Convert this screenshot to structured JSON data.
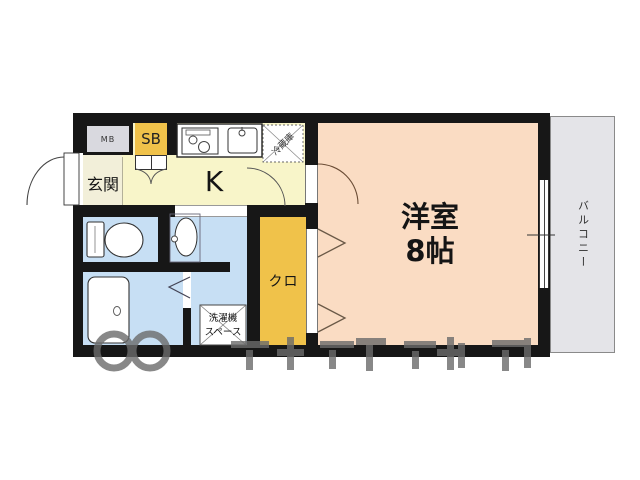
{
  "plan": {
    "labels": {
      "meter_box": "MB",
      "shoe_box": "SB",
      "genkan": "玄関",
      "kitchen": "K",
      "refrigerator": "冷蔵庫",
      "main_room_name": "洋室",
      "main_room_size": "8帖",
      "closet": "クロ",
      "laundry_line1": "洗濯機",
      "laundry_line2": "スペース",
      "balcony": "バルコニー"
    },
    "colors": {
      "wall": "#171717",
      "kitchen_floor": "#f8f5c9",
      "genkan_floor": "#f2efd9",
      "sanitary_floor": "#c7dff4",
      "room_floor": "#fadcc3",
      "accent_orange": "#f0c24a",
      "balcony_gray": "#e4e4e8",
      "meter_box_gray": "#d9d9df",
      "watermark_gray": "#6b6b6b"
    }
  }
}
